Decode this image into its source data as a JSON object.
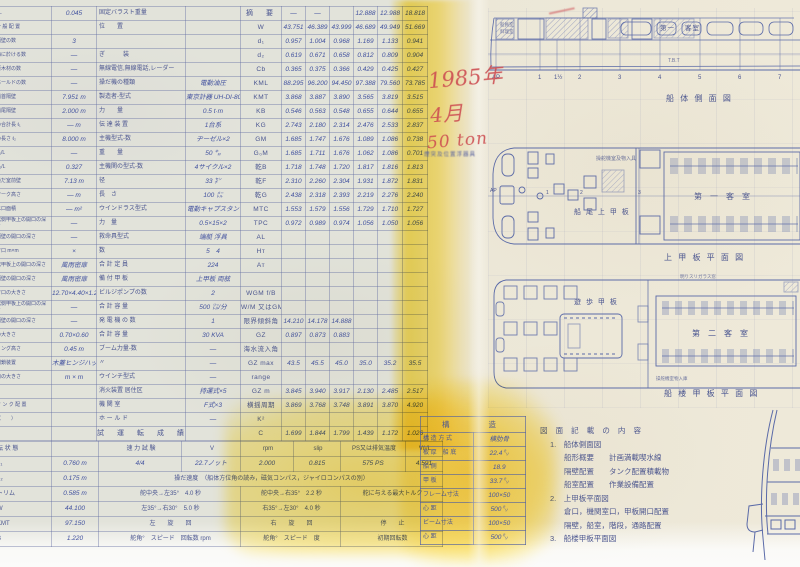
{
  "document": {
    "kind": "scanned ship specification sheet with general arrangement drawings",
    "accent_colors": {
      "ink_blue": "#4a5590",
      "highlighter_yellow": "#ffd400",
      "pen_red": "#cd4e52"
    }
  },
  "annotations": {
    "red_year": "1985年",
    "red_month": "4月",
    "red_tonnage": "50 ton",
    "blue_note": "煙突及位置浮器具"
  },
  "spec_table": {
    "rows": [
      {
        "a": "r/L",
        "av": "0.045",
        "b": "固定バラスト重量",
        "bv": "",
        "s": "摘　要",
        "n": [
          "—",
          "—",
          "",
          "12.888",
          "12.988",
          "18.818"
        ]
      },
      {
        "a": "一 般 配 置",
        "av": "",
        "b": "位　　置",
        "bv": "",
        "s": "W",
        "n": [
          "43.751",
          "46.389",
          "43.999",
          "46.689",
          "49.949",
          "51.669"
        ]
      },
      {
        "a": "隔壁の数",
        "av": "3",
        "b": "",
        "bv": "",
        "s": "d₁",
        "n": [
          "0.957",
          "1.004",
          "0.968",
          "1.169",
          "1.133",
          "0.941"
        ]
      },
      {
        "a": "海に於ける数",
        "av": "—",
        "b": "ぎ　　　装",
        "bv": "",
        "s": "d₂",
        "n": [
          "0.619",
          "0.671",
          "0.658",
          "0.812",
          "0.809",
          "0.904"
        ]
      },
      {
        "a": "原木材の数",
        "av": "—",
        "b": "無線電信,無線電話,レーダー",
        "bv": "",
        "s": "Cb",
        "n": [
          "0.365",
          "0.375",
          "0.366",
          "0.429",
          "0.425",
          "0.427"
        ]
      },
      {
        "a": "ホールドの数",
        "av": "—",
        "b": "操だ機の種類",
        "bv": "電動油圧",
        "s": "KML",
        "n": [
          "88.295",
          "96.200",
          "94.450",
          "97.388",
          "79.560",
          "73.785"
        ]
      },
      {
        "a": "船首隔壁",
        "av": "7.951 m",
        "b": "製造者-型式",
        "bv": "東京計器 UH-DI-805",
        "s": "KMT",
        "n": [
          "3.868",
          "3.887",
          "3.890",
          "3.565",
          "3.819",
          "3.515"
        ]
      },
      {
        "a": "船尾隔壁",
        "av": "2.000 m",
        "b": "力　　量",
        "bv": "0.5 t·m",
        "s": "KB",
        "n": [
          "0.546",
          "0.563",
          "0.548",
          "0.655",
          "0.644",
          "0.655"
        ]
      },
      {
        "a": "の合計長 ℓ₁",
        "av": "— m",
        "b": "伝 達 装 置",
        "bv": "1台系",
        "s": "KG",
        "n": [
          "2.743",
          "2.180",
          "2.314",
          "2.476",
          "2.533",
          "2.837"
        ]
      },
      {
        "a": "の長さ ℓ₂",
        "av": "8.000 m",
        "b": "主機型式-数",
        "bv": "ヂーゼル×2",
        "s": "GM",
        "n": [
          "1.685",
          "1.747",
          "1.676",
          "1.089",
          "1.086",
          "0.738"
        ]
      },
      {
        "a": "B₁/L",
        "av": "—",
        "b": "重　　量",
        "bv": "50 ㌔",
        "s": "G₀M",
        "n": [
          "1.685",
          "1.711",
          "1.676",
          "1.062",
          "1.086",
          "0.701"
        ]
      },
      {
        "a": "B₂/L",
        "av": "0.327",
        "b": "主機関の型式-数",
        "bv": "4サイクル×2",
        "s": "乾B",
        "n": [
          "1.718",
          "1.748",
          "1.720",
          "1.817",
          "1.816",
          "1.813"
        ]
      },
      {
        "a": "操だ室前壁",
        "av": "7.13 m",
        "b": "径",
        "bv": "33 ㌢",
        "s": "乾F",
        "n": [
          "2.310",
          "2.260",
          "2.304",
          "1.931",
          "1.872",
          "1.831"
        ]
      },
      {
        "a": "マーク高さ",
        "av": "— m",
        "b": "長　さ",
        "bv": "100 ㍍",
        "s": "乾G",
        "n": [
          "2.438",
          "2.318",
          "2.393",
          "2.219",
          "2.276",
          "2.240"
        ]
      },
      {
        "a": "水口面積",
        "av": "— m²",
        "b": "ウインドラス型式",
        "bv": "電動キャプスタン",
        "s": "MTC",
        "n": [
          "1.553",
          "1.579",
          "1.556",
          "1.729",
          "1.710",
          "1.727"
        ]
      },
      {
        "a": "舷側甲板上の開口の深さ",
        "av": "—",
        "b": "力　量",
        "bv": "0.5×15×2",
        "s": "TPC",
        "n": [
          "0.972",
          "0.989",
          "0.974",
          "1.056",
          "1.050",
          "1.056"
        ]
      },
      {
        "a": "隔壁の開口の深さ",
        "av": "—",
        "b": "救命具型式",
        "bv": "端艇 浮具",
        "s": "AL",
        "n": [
          "",
          "",
          "",
          "",
          "",
          ""
        ]
      },
      {
        "a": "倉口 m×m",
        "av": "×",
        "b": "数",
        "bv": "5　4",
        "s": "Hт",
        "n": [
          "",
          "",
          "",
          "",
          "",
          ""
        ]
      },
      {
        "a": "舷甲板上の開口の深さ",
        "av": "風雨密扉",
        "b": "合 計 定 員",
        "bv": "224",
        "s": "Aт",
        "n": [
          "",
          "",
          "",
          "",
          "",
          ""
        ]
      },
      {
        "a": "隔壁の開口の深さ",
        "av": "風雨密扉",
        "b": "備 付 甲 板",
        "bv": "上甲板 両舷",
        "s": "",
        "n": [
          "",
          "",
          "",
          "",
          "",
          ""
        ]
      },
      {
        "a": "倉口の大きさ",
        "av": "12.70×4.40×1.20",
        "b": "ビルジポンプの数",
        "bv": "2",
        "s": "WGM f/B",
        "n": [
          "",
          "",
          "",
          "",
          "",
          ""
        ]
      },
      {
        "a": "舷側甲板上の開口の深さ",
        "av": "—",
        "b": "合 計 容 量",
        "bv": "500 ㍑/分",
        "s": "W/M 又はGM",
        "n": [
          "",
          "",
          "",
          "",
          "",
          ""
        ]
      },
      {
        "a": "隔壁の開口の深さ",
        "av": "—",
        "b": "発 電 機 の 数",
        "bv": "1",
        "s": "限界傾斜角",
        "n": [
          "14.210",
          "14.178",
          "14.888",
          "",
          "",
          ""
        ]
      },
      {
        "a": "の大きさ",
        "av": "0.70×0.60",
        "b": "合 計 容 量",
        "bv": "30 KVA",
        "s": "GZ",
        "n": [
          "0.897",
          "0.873",
          "0.883",
          "",
          "",
          ""
        ]
      },
      {
        "a": "ミング高さ",
        "av": "0.45 m",
        "b": "ブーム力量-数",
        "bv": "—",
        "s": "海水流入角",
        "n": [
          "",
          "",
          "",
          "",
          "",
          ""
        ]
      },
      {
        "a": "閉鎖装置",
        "av": "木蓋ヒンジハッチ",
        "b": "〃",
        "bv": "—",
        "s": "GZ max",
        "n": [
          "43.5",
          "45.5",
          "45.0",
          "35.0",
          "35.2",
          "35.5"
        ]
      },
      {
        "a": "口の大きさ",
        "av": "m × m",
        "b": "ウインチ型式",
        "bv": "—",
        "s": "range",
        "n": [
          "",
          "",
          "",
          "",
          "",
          ""
        ]
      },
      {
        "a": "",
        "av": "",
        "b": "消火装置 居住区",
        "bv": "持運式×5",
        "s": "GZ m",
        "n": [
          "3.845",
          "3.940",
          "3.917",
          "2.130",
          "2.485",
          "2.517"
        ]
      },
      {
        "a": "タ ン ク 配 置",
        "av": "",
        "b": "機 関 室",
        "bv": "F式×3",
        "s": "横揺周期",
        "n": [
          "3.869",
          "3.768",
          "3.748",
          "3.891",
          "3.870",
          "4.920"
        ]
      },
      {
        "a": "（　　）",
        "av": "",
        "b": "ホ ー ル ド",
        "bv": "—",
        "s": "K²",
        "n": [
          "",
          "",
          "",
          "",
          "",
          ""
        ]
      },
      {
        "a": "",
        "av": "",
        "b": "試　運　転　成　績",
        "bv": "",
        "s": "C",
        "n": [
          "1.699",
          "1.844",
          "1.799",
          "1.439",
          "1.172",
          "1.026"
        ]
      }
    ]
  },
  "trial_table": {
    "rows": [
      [
        {
          "t": "転 状 態"
        },
        {
          "t": ""
        },
        {
          "t": "速 力 試 験"
        },
        {
          "t": "V"
        },
        {
          "t": "rpm"
        },
        {
          "t": "slip"
        },
        {
          "t": "PS又は排気温度"
        },
        {
          "t": "V/√L"
        }
      ],
      [
        {
          "t": "d₁"
        },
        {
          "t": "0.760 m"
        },
        {
          "t": "4/4"
        },
        {
          "t": "22.7ノット"
        },
        {
          "t": "2.000"
        },
        {
          "t": "0.815"
        },
        {
          "t": "575 PS"
        },
        {
          "t": "4.591"
        }
      ],
      [
        {
          "t": "d₂"
        },
        {
          "t": "0.175 m"
        },
        {
          "t": "操だ速度　（船体方位角の読み，磁気コンパス，ジャイロコンパスの別）",
          "s": 6
        }
      ],
      [
        {
          "t": "トリム"
        },
        {
          "t": "0.585 m"
        },
        {
          "t": "舵中央→左35°　4.0 秒",
          "s": 2
        },
        {
          "t": "舵中央→右35°　2.2 秒",
          "s": 2
        },
        {
          "t": "舵に与える最大トルク",
          "s": 2
        }
      ],
      [
        {
          "t": "W"
        },
        {
          "t": "44.100"
        },
        {
          "t": "左35°→右30°　5.0 秒",
          "s": 2
        },
        {
          "t": "右35°→左30°　4.0 秒",
          "s": 2
        },
        {
          "t": "",
          "s": 2
        }
      ],
      [
        {
          "t": "KMT"
        },
        {
          "t": "97.150"
        },
        {
          "t": "左　　旋　　回",
          "s": 2
        },
        {
          "t": "右　　旋　　回",
          "s": 2
        },
        {
          "t": "停　　止",
          "s": 2
        }
      ],
      [
        {
          "t": "B"
        },
        {
          "t": "1.220"
        },
        {
          "t": "舵角°　スピード　回転数 rpm",
          "s": 2
        },
        {
          "t": "舵角°　スピード　度",
          "s": 2
        },
        {
          "t": "初期回転数",
          "s": 2
        }
      ]
    ]
  },
  "structure_box": {
    "title": "構　　造",
    "rows": [
      [
        "構 造 方 式",
        "横肋骨"
      ],
      [
        "板 厚　船 底",
        "22.4㍉"
      ],
      [
        "船 側",
        "18.9"
      ],
      [
        "甲 板",
        "33.7㍉"
      ],
      [
        "フレーム寸法",
        "100×50"
      ],
      [
        "心 距",
        "500㍉"
      ],
      [
        "ビーム寸法",
        "100×50"
      ],
      [
        "心 距",
        "500㍉"
      ]
    ]
  },
  "contents_list": {
    "lines": [
      {
        "cls": "t0",
        "text": "図 面 記 載 の 内 容"
      },
      {
        "cls": "ind1",
        "text": "1.　船体側面図"
      },
      {
        "cls": "ind2",
        "text": "船形概要　　計画満載喫水線"
      },
      {
        "cls": "ind2",
        "text": "隔壁配置　　タンク配置積載物"
      },
      {
        "cls": "ind2",
        "text": "船室配置　　作業設備配置"
      },
      {
        "cls": "ind1",
        "text": "2.　上甲板平面図"
      },
      {
        "cls": "ind2",
        "text": "倉口，機関室口，甲板開口配置"
      },
      {
        "cls": "ind2",
        "text": "隔壁，船室，階段，通路配置"
      },
      {
        "cls": "ind1",
        "text": "3.　船楼甲板平面図"
      }
    ]
  },
  "drawings": {
    "side_view": {
      "title": "船 体 側 面 図",
      "window_label_1": "第一",
      "window_label_2": "客室",
      "stern_note_1": "船員室",
      "stern_note_2": "料理室",
      "mid_note": "T.B.T",
      "frame_labels": [
        "AP",
        "1",
        "1½",
        "2",
        "3",
        "4",
        "5",
        "6",
        "7"
      ]
    },
    "upper_deck": {
      "title": "上 甲 板 平 面 図",
      "area_label": "船 尾 上 甲 板",
      "room_label": "第　一　客　室",
      "note": "操舵機室及物入具",
      "ap_label": "AP",
      "frame_numbers": [
        "1",
        "2",
        "3"
      ]
    },
    "boat_deck": {
      "title": "船 楼 甲 板 平 面 図",
      "area_label": "遊 歩 甲 板",
      "room_label": "第　二　客　室",
      "note_top": "明りスリガラス窓",
      "note_bottom": "操舵機室物入庫"
    }
  }
}
